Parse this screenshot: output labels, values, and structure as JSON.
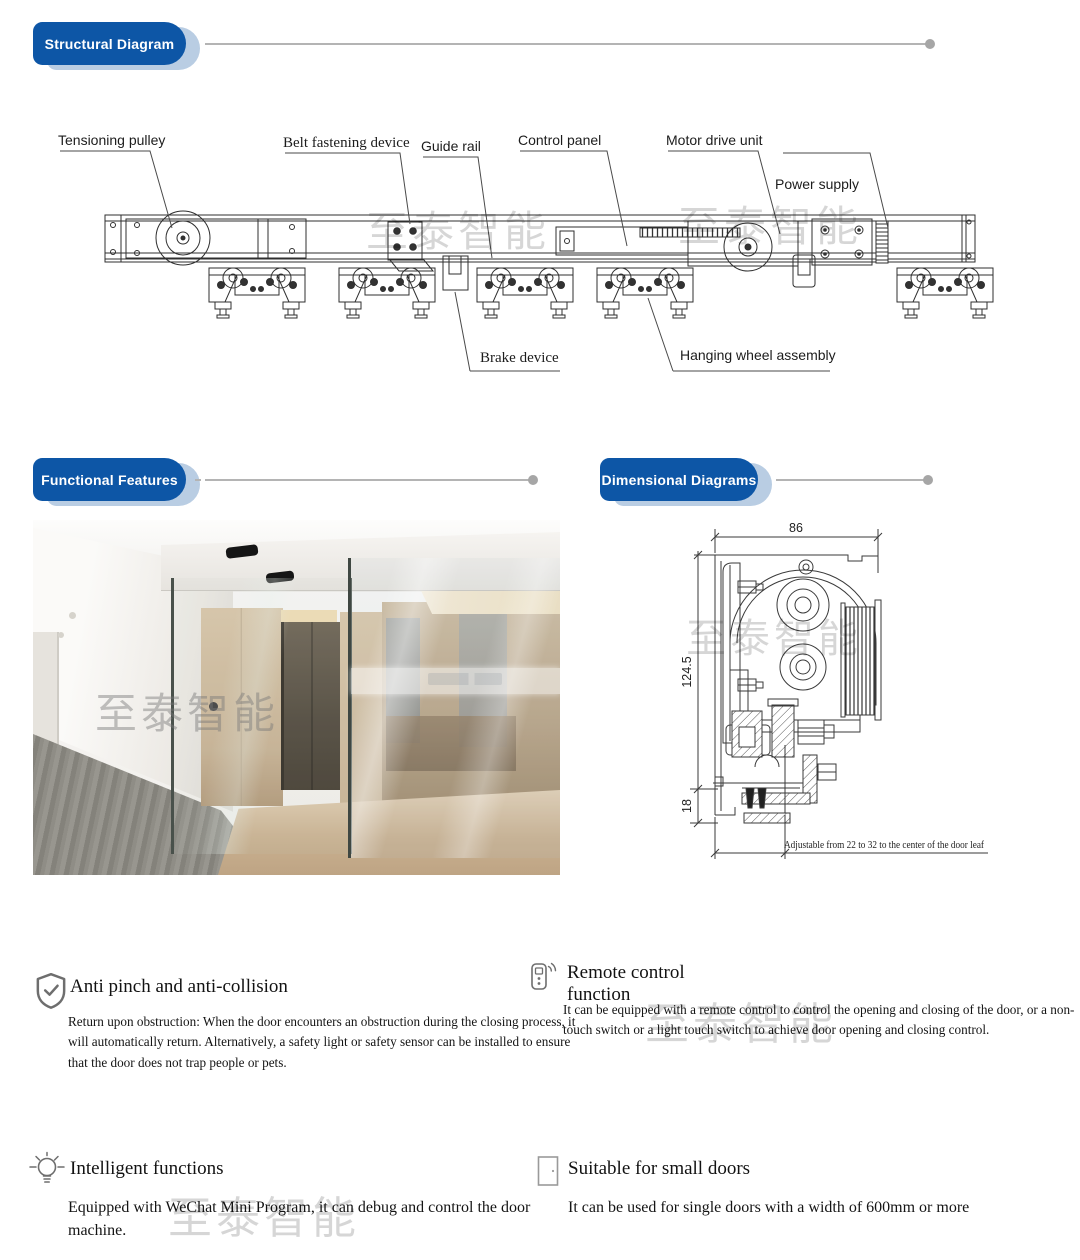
{
  "watermark": "至泰智能",
  "theme": {
    "badge_blue": "#0d56a6",
    "badge_shadow": "#b9cde3",
    "rule_gray": "#b4b4b4",
    "drawing_line": "#2f2f2f"
  },
  "headers": {
    "structural": "Structural Diagram",
    "functional": "Functional Features",
    "dimensional": "Dimensional Diagrams"
  },
  "structural": {
    "labels": {
      "tensioning_pulley": "Tensioning pulley",
      "belt_fastening_device": "Belt fastening device",
      "guide_rail": "Guide rail",
      "control_panel": "Control panel",
      "motor_drive_unit": "Motor drive unit",
      "power_supply": "Power supply",
      "brake_device": "Brake device",
      "hanging_wheel_assembly": "Hanging wheel assembly"
    }
  },
  "dimensional": {
    "width": "86",
    "height": "124.5",
    "bottom_offset": "18",
    "note": "Adjustable from 22 to 32 to the center of the door leaf"
  },
  "features": {
    "anti_pinch": {
      "icon": "shield-check-icon",
      "title": "Anti pinch and anti-collision",
      "body": "Return upon obstruction: When the door encounters an obstruction during the closing process, it will automatically return. Alternatively, a safety light or safety sensor can be installed to ensure that the door does not trap people or pets."
    },
    "remote": {
      "icon": "remote-control-icon",
      "title": "Remote control function",
      "body": "It can be equipped with a remote control to control the opening and closing of the door, or a non-touch switch or a light touch switch to achieve door opening and closing control."
    },
    "intelligent": {
      "icon": "lightbulb-icon",
      "title": "Intelligent functions",
      "body": "Equipped with WeChat Mini Program, it can debug and control the door machine."
    },
    "small_doors": {
      "icon": "door-icon",
      "title": "Suitable for small doors",
      "body": "It can be used for single doors with a width of 600mm or more"
    }
  }
}
